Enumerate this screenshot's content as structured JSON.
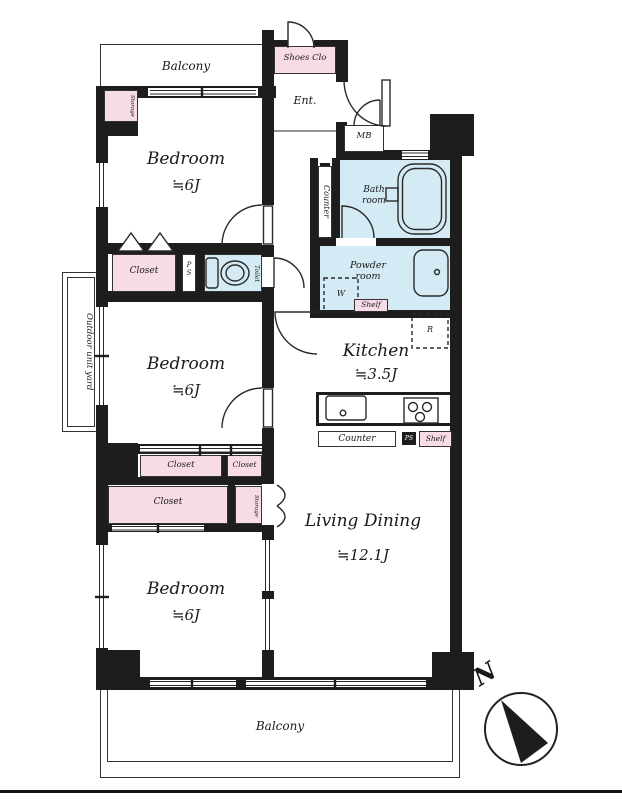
{
  "colors": {
    "wall": "#1d1d1d",
    "pink": "#f7dbe7",
    "blue": "#d4ebf5",
    "line": "#2a2a2a"
  },
  "rooms": {
    "balcony_top": {
      "label": "Balcony"
    },
    "shoes_clo": {
      "label": "Shoes Clo"
    },
    "ent": {
      "label": "Ent."
    },
    "mb": {
      "label": "MB"
    },
    "bath": {
      "line1": "Bath",
      "line2": "room"
    },
    "counter_wall": {
      "label": "Counter"
    },
    "powder": {
      "line1": "Powder",
      "line2": "room"
    },
    "washer": {
      "label": "W"
    },
    "shelf_powder": {
      "label": "Shelf"
    },
    "fridge": {
      "label": "R"
    },
    "toilet": {
      "label": "Toilet"
    },
    "pipe_shaft_upper": {
      "label": "P S"
    },
    "storage_top": {
      "label": "Storage"
    },
    "closet_1": {
      "label": "Closet"
    },
    "bedroom_1": {
      "name": "Bedroom",
      "size": "≒6J"
    },
    "outdoor_unit_yard": {
      "label": "Outdoor unit yard"
    },
    "bedroom_2": {
      "name": "Bedroom",
      "size": "≒6J"
    },
    "kitchen": {
      "name": "Kitchen",
      "size": "≒3.5J"
    },
    "closet_2a": {
      "label": "Closet"
    },
    "closet_2b": {
      "label": "Closet"
    },
    "closet_3": {
      "label": "Closet"
    },
    "storage_mid": {
      "label": "Storage"
    },
    "counter_kitchen": {
      "label": "Counter"
    },
    "pipe_shaft_kitchen": {
      "label": "PS"
    },
    "shelf_kitchen": {
      "label": "Shelf"
    },
    "living_dining": {
      "name": "Living Dining",
      "size": "≒12.1J"
    },
    "bedroom_3": {
      "name": "Bedroom",
      "size": "≒6J"
    },
    "balcony_bottom": {
      "label": "Balcony"
    }
  },
  "compass": {
    "north_label": "N"
  }
}
